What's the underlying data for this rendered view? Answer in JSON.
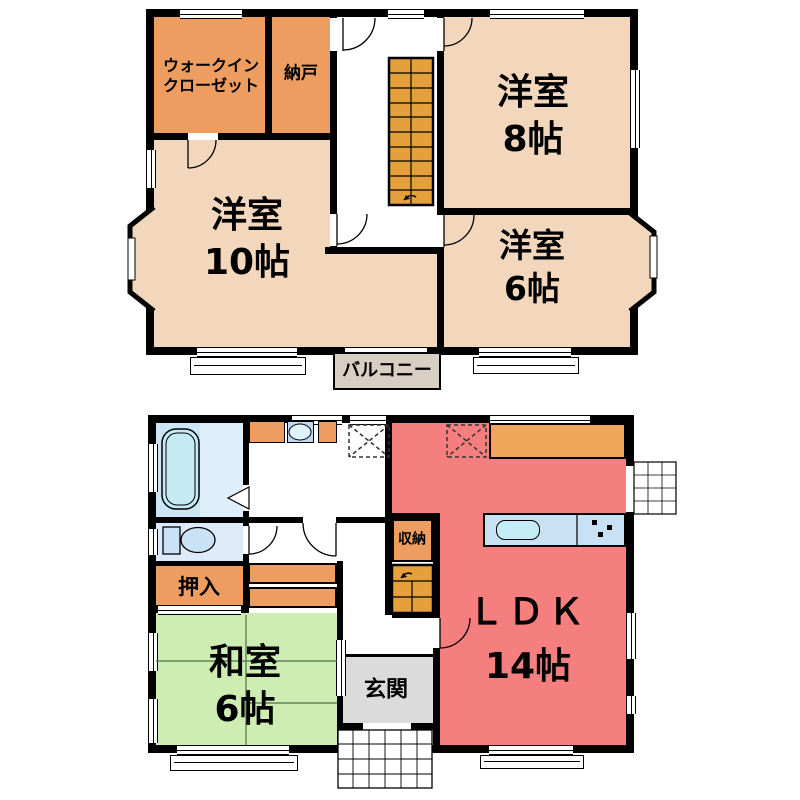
{
  "floor2": {
    "walk_in_closet": {
      "line1": "ウォークイン",
      "line2": "クローゼット"
    },
    "nando": {
      "label": "納戸"
    },
    "room8": {
      "name": "洋室",
      "size": "8帖"
    },
    "room10": {
      "name": "洋室",
      "size": "10帖"
    },
    "room6": {
      "name": "洋室",
      "size": "6帖"
    },
    "balcony": {
      "label": "バルコニー"
    }
  },
  "floor1": {
    "oshiire": {
      "label": "押入"
    },
    "washitsu": {
      "name": "和室",
      "size": "6帖"
    },
    "genkan": {
      "label": "玄関"
    },
    "shuno": {
      "label": "収納"
    },
    "ldk": {
      "name": "ＬＤＫ",
      "size": "14帖"
    }
  },
  "colors": {
    "western_room": "#F3D7BC",
    "closet_orange": "#EC9D5F",
    "stairs_orange": "#E5A03C",
    "ldk_red": "#F57F7F",
    "tatami_green": "#CDEDB3",
    "balcony_beige": "#D8CEC2",
    "entry_gray": "#DBDBDB",
    "bath_blue": "#D6E9F8",
    "counter_blue": "#C8E1F5",
    "wall_black": "#000000"
  }
}
